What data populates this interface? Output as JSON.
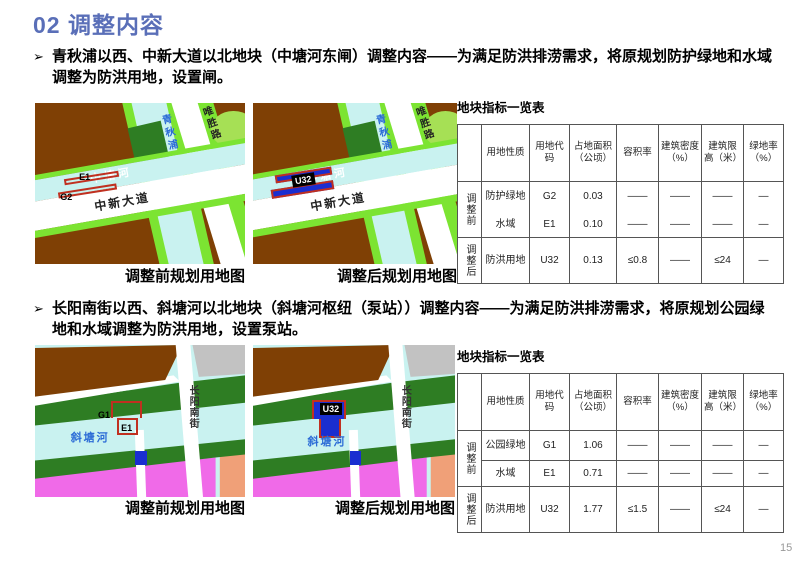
{
  "title": "02 调整内容",
  "page_number": "15",
  "colors": {
    "accent": "#5a6fb8",
    "map_brown": "#7f4005",
    "map_green_bright": "#7ce432",
    "map_cyan": "#c9f2f0",
    "map_green_dark": "#2e7d23",
    "map_magenta": "#f06ae8",
    "map_salmon": "#f0a078",
    "map_gray": "#c2c2c2",
    "map_blue": "#1a2ed0",
    "parcel_red": "#c03020",
    "river_label_blue": "#2b6bd6"
  },
  "section1": {
    "marker": "➢",
    "text": "青秋浦以西、中新大道以北地块（中塘河东闸）调整内容——为满足防洪排涝需求，将原规划防护绿地和水域调整为防洪用地，设置闸。",
    "before_caption": "调整前规划用地图",
    "after_caption": "调整后规划用地图",
    "labels": {
      "qingqiupu": "青秋浦",
      "weishenglu": "唯胜路",
      "zhongtanghe": "中塘河",
      "zhongxindadao": "中新大道",
      "e1": "E1",
      "g2": "G2",
      "u32": "U32"
    }
  },
  "section2": {
    "marker": "➢",
    "text": "长阳南街以西、斜塘河以北地块（斜塘河枢纽（泵站））调整内容——为满足防洪排涝需求，将原规划公园绿地和水域调整为防洪用地，设置泵站。",
    "before_caption": "调整前规划用地图",
    "after_caption": "调整后规划用地图",
    "labels": {
      "xietanghe": "斜塘河",
      "changyangnanjie": "长阳南街",
      "g1": "G1",
      "e1": "E1",
      "u32": "U32"
    }
  },
  "table1": {
    "title": "地块指标一览表",
    "headers": [
      "",
      "用地性质",
      "用地代码",
      "占地面积（公顷）",
      "容积率",
      "建筑密度（%）",
      "建筑限高（米）",
      "绿地率（%）"
    ],
    "groups": [
      {
        "label": "调整前",
        "rows": [
          {
            "cells": [
              "防护绿地",
              "G2",
              "0.03",
              "——",
              "——",
              "——",
              "—"
            ]
          },
          {
            "cells": [
              "水域",
              "E1",
              "0.10",
              "——",
              "——",
              "——",
              "—"
            ]
          }
        ]
      },
      {
        "label": "调整后",
        "rows": [
          {
            "cells": [
              "防洪用地",
              "U32",
              "0.13",
              "≤0.8",
              "——",
              "≤24",
              "—"
            ]
          }
        ]
      }
    ]
  },
  "table2": {
    "title": "地块指标一览表",
    "headers": [
      "",
      "用地性质",
      "用地代码",
      "占地面积（公顷）",
      "容积率",
      "建筑密度（%）",
      "建筑限高（米）",
      "绿地率（%）"
    ],
    "groups": [
      {
        "label": "调整前",
        "rows": [
          {
            "cells": [
              "公园绿地",
              "G1",
              "1.06",
              "——",
              "——",
              "——",
              "—"
            ]
          },
          {
            "cells": [
              "水域",
              "E1",
              "0.71",
              "——",
              "——",
              "——",
              "—"
            ]
          }
        ]
      },
      {
        "label": "调整后",
        "rows": [
          {
            "cells": [
              "防洪用地",
              "U32",
              "1.77",
              "≤1.5",
              "——",
              "≤24",
              "—"
            ]
          }
        ]
      }
    ]
  }
}
